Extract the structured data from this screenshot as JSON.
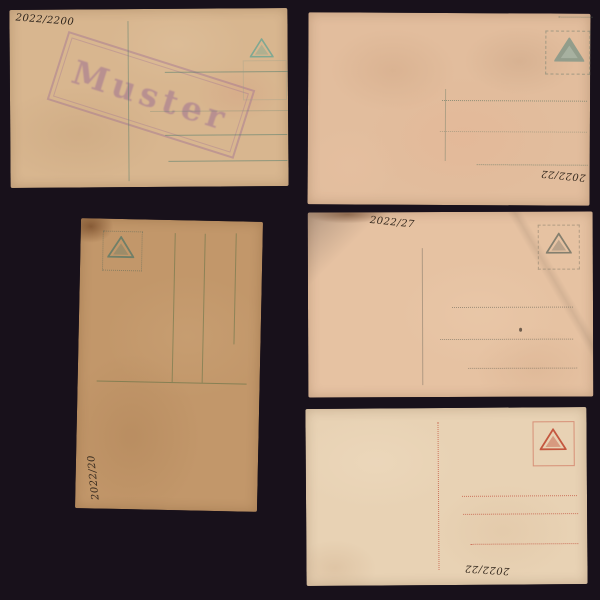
{
  "scene": {
    "background_color": "#18111b",
    "item_count": 5
  },
  "cards": [
    {
      "position": "top-left",
      "orientation": "landscape",
      "handwriting": "2022/2200",
      "stamp_text": "Muster",
      "stamp_color": "#8f5f96",
      "paper_color": "#d8b68f",
      "line_color": "#467869",
      "logo_icon": "triangle-logo"
    },
    {
      "position": "top-right",
      "orientation": "landscape",
      "handwriting": "2022/22",
      "paper_color": "#e2bd9d",
      "line_color": "#647864",
      "logo_icon": "triangle-logo"
    },
    {
      "position": "middle-left",
      "orientation": "portrait-rotated",
      "handwriting": "2022/20",
      "paper_color": "#c2976a",
      "line_color": "#556e41",
      "logo_icon": "triangle-logo"
    },
    {
      "position": "middle-right",
      "orientation": "landscape",
      "handwriting": "2022/27",
      "paper_color": "#e6c2a2",
      "line_color": "#6e695a",
      "logo_icon": "triangle-logo"
    },
    {
      "position": "bottom-right",
      "orientation": "landscape",
      "handwriting": "2022/22",
      "paper_color": "#e8d2b4",
      "line_color": "#c35541",
      "logo_icon": "triangle-logo"
    }
  ]
}
